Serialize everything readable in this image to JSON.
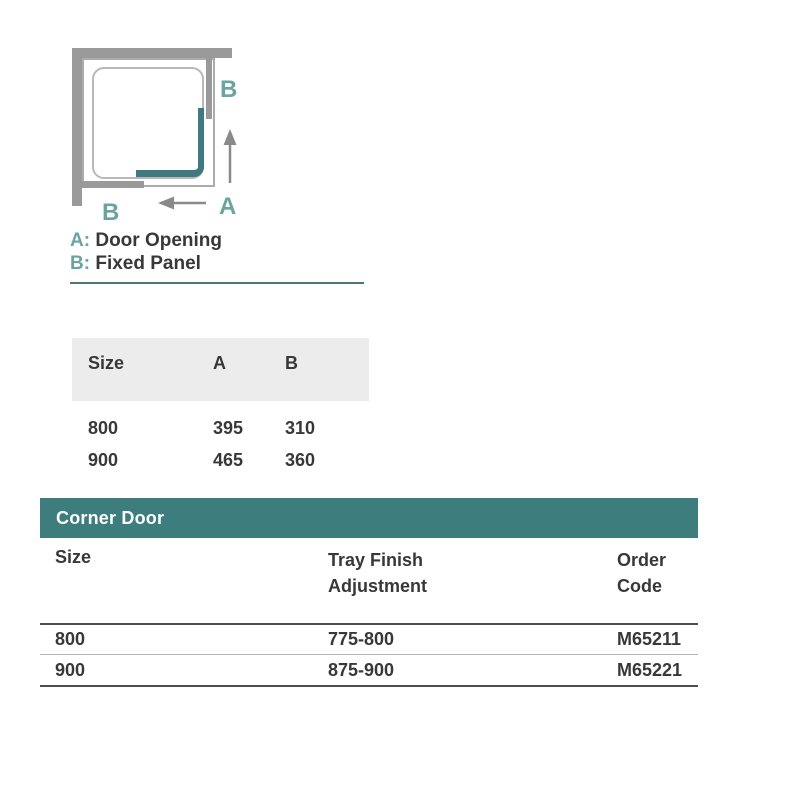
{
  "diagram": {
    "label_b_top": "B",
    "label_a_bottom": "A",
    "label_b_bottom": "B"
  },
  "legend": {
    "a_prefix": "A:",
    "a_label": "Door Opening",
    "b_prefix": "B:",
    "b_label": "Fixed Panel"
  },
  "size_table": {
    "headers": [
      "Size",
      "A",
      "B"
    ],
    "rows": [
      [
        "800",
        "395",
        "310"
      ],
      [
        "900",
        "465",
        "360"
      ]
    ]
  },
  "order_table": {
    "title": "Corner Door",
    "col_size": "Size",
    "col_tray_line1": "Tray Finish",
    "col_tray_line2": "Adjustment",
    "col_order_line1": "Order",
    "col_order_line2": "Code",
    "rows": [
      [
        "800",
        "775-800",
        "M65211"
      ],
      [
        "900",
        "875-900",
        "M65221"
      ]
    ]
  },
  "colors": {
    "teal_banner": "#3d7d7d",
    "teal_label": "#6aa3a1",
    "door_teal": "#3f7a80",
    "wall_gray": "#9a9a9a",
    "divider_teal": "#4c7573",
    "text_dark": "#383838"
  }
}
